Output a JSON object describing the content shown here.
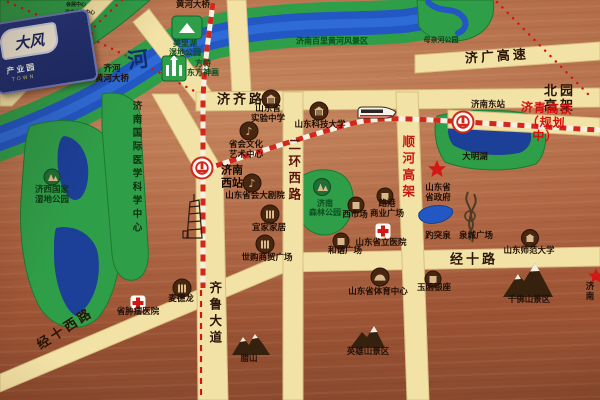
{
  "sign": {
    "main": "大风",
    "sub": "产业园",
    "tag": "TOWN"
  },
  "colors": {
    "copper_bg": "#aa5f3e",
    "road": "#f2e2a6",
    "road_edge": "#d9bf82",
    "park_green": "#2f9e49",
    "park_edge": "#1b7a33",
    "water_blue": "#2257c4",
    "lake_dark": "#1c3f98",
    "rail_red": "#d3261c",
    "rail_white": "#f5f1e2",
    "hsr_text_red": "#d40f0f",
    "label_dark": "#211007",
    "badge_brown": "#48260f",
    "badge_tan": "#d9b98c",
    "mountain_brown": "#36200e",
    "star_red": "#d21717",
    "cross_red": "#d21717"
  },
  "icons": [
    "railway-station-icon",
    "red-cross-icon",
    "red-star-icon",
    "mountain-icon",
    "building-badge-icon",
    "music-badge-icon",
    "trees-badge-icon",
    "stadium-badge-icon",
    "castle-park-icon",
    "wetland-hill-icon",
    "spring-sculpture-icon",
    "hst-train-icon",
    "tower-sketch-icon",
    "wetland-badge-icon"
  ],
  "map": {
    "labels": [
      {
        "name": "label-huanghe-bridge-top",
        "t": "黄河大桥",
        "x": 193,
        "y": 6,
        "cls": "poi"
      },
      {
        "name": "label-qihe-huanghe-bridge",
        "t": "齐河\n黄河大桥",
        "x": 112,
        "y": 75,
        "cls": "poi"
      },
      {
        "name": "label-jiqi-road",
        "t": "济齐路",
        "x": 241,
        "y": 101,
        "cls": "road"
      },
      {
        "name": "label-beiyuan-elevated",
        "t": "北园高架",
        "x": 560,
        "y": 100,
        "cls": "road"
      },
      {
        "name": "label-jiguang-expressway",
        "t": "济广高速",
        "x": 497,
        "y": 58,
        "cls": "road",
        "rot": -4
      },
      {
        "name": "label-jiqing-hsr",
        "t": "济青高铁（规划中）",
        "x": 546,
        "y": 123,
        "cls": "hsr",
        "rot": 3
      },
      {
        "name": "label-jinan-east-station",
        "t": "济南东站",
        "x": 488,
        "y": 106,
        "cls": "poi"
      },
      {
        "name": "label-shunhe-elevated",
        "t": "顺河高架",
        "x": 407,
        "y": 168,
        "cls": "roadv red-road"
      },
      {
        "name": "label-erhuan-west-road",
        "t": "二环西路",
        "x": 293,
        "y": 171,
        "cls": "roadv dark-red-road"
      },
      {
        "name": "label-qilu-avenue",
        "t": "齐鲁大道",
        "x": 214,
        "y": 314,
        "cls": "roadv"
      },
      {
        "name": "label-jingshi-road",
        "t": "经十路",
        "x": 474,
        "y": 261,
        "cls": "road"
      },
      {
        "name": "label-jingshi-west-road",
        "t": "经十西路",
        "x": 66,
        "y": 330,
        "cls": "road",
        "rot": -33
      },
      {
        "name": "label-yellow-river-char",
        "t": "河",
        "x": 138,
        "y": 60,
        "cls": "riverchar",
        "rot": -8
      },
      {
        "name": "label-baili-scenic",
        "t": "济南百里黄河风景区",
        "x": 332,
        "y": 41,
        "cls": "park-sm"
      },
      {
        "name": "label-mother-river-park",
        "t": "母亲河公园",
        "x": 441,
        "y": 40,
        "cls": "park-xs"
      },
      {
        "name": "label-meilihu-park",
        "t": "美里湖\n湿地公园",
        "x": 185,
        "y": 48,
        "cls": "park-sm"
      },
      {
        "name": "label-fangte-park",
        "t": "方特\n东方神画",
        "x": 203,
        "y": 68,
        "cls": "park-sm"
      },
      {
        "name": "label-jixi-wetland",
        "t": "济西国家\n湿地公园",
        "x": 52,
        "y": 196,
        "cls": "park-dark"
      },
      {
        "name": "label-medical-center",
        "t": "济南国际医学科学中心",
        "x": 135,
        "y": 168,
        "cls": "parkv"
      },
      {
        "name": "label-forest-park",
        "t": "济南\n森林公园",
        "x": 325,
        "y": 208,
        "cls": "park-sm"
      },
      {
        "name": "label-daming-lake",
        "t": "大明湖",
        "x": 475,
        "y": 158,
        "cls": "poi"
      },
      {
        "name": "label-experimental-school",
        "t": "山东省\n实验中学",
        "x": 268,
        "y": 115,
        "cls": "poi"
      },
      {
        "name": "label-sdust",
        "t": "山东科技大学",
        "x": 320,
        "y": 126,
        "cls": "poi"
      },
      {
        "name": "label-culture-art-center",
        "t": "省会文化\n艺术中心",
        "x": 246,
        "y": 151,
        "cls": "poi"
      },
      {
        "name": "label-grand-theatre",
        "t": "山东省会大剧院",
        "x": 255,
        "y": 197,
        "cls": "poi"
      },
      {
        "name": "label-jinan-west-station",
        "t": "济南\n西站",
        "x": 232,
        "y": 177,
        "cls": "station"
      },
      {
        "name": "label-ikea",
        "t": "宜家家居",
        "x": 269,
        "y": 229,
        "cls": "poi"
      },
      {
        "name": "label-shigou-plaza",
        "t": "世购商贸广场",
        "x": 267,
        "y": 259,
        "cls": "poi"
      },
      {
        "name": "label-west-market",
        "t": "西市场",
        "x": 355,
        "y": 216,
        "cls": "poi"
      },
      {
        "name": "label-lugang-plaza",
        "t": "路港\n商业广场",
        "x": 387,
        "y": 210,
        "cls": "poi"
      },
      {
        "name": "label-hexie-plaza",
        "t": "和谐广场",
        "x": 345,
        "y": 252,
        "cls": "poi"
      },
      {
        "name": "label-provincial-hospital",
        "t": "山东省立医院",
        "x": 381,
        "y": 244,
        "cls": "poi"
      },
      {
        "name": "label-baotu-spring",
        "t": "趵突泉",
        "x": 438,
        "y": 237,
        "cls": "poi"
      },
      {
        "name": "label-quancheng-square",
        "t": "泉城广场",
        "x": 476,
        "y": 237,
        "cls": "poi"
      },
      {
        "name": "label-prov-government",
        "t": "山东省\n省政府",
        "x": 438,
        "y": 194,
        "cls": "poi"
      },
      {
        "name": "label-shandong-normal-univ",
        "t": "山东师范大学",
        "x": 529,
        "y": 252,
        "cls": "poi"
      },
      {
        "name": "label-yuhan-yinzuo",
        "t": "玉函银座",
        "x": 434,
        "y": 289,
        "cls": "poi"
      },
      {
        "name": "label-sports-center",
        "t": "山东省体育中心",
        "x": 378,
        "y": 293,
        "cls": "poi"
      },
      {
        "name": "label-metro-store",
        "t": "麦德龙",
        "x": 181,
        "y": 300,
        "cls": "poi"
      },
      {
        "name": "label-tumor-hospital",
        "t": "省肿瘤医院",
        "x": 138,
        "y": 313,
        "cls": "poi"
      },
      {
        "name": "label-lashan",
        "t": "腊山",
        "x": 249,
        "y": 360,
        "cls": "poi"
      },
      {
        "name": "label-yingxiongshan",
        "t": "英雄山景区",
        "x": 368,
        "y": 353,
        "cls": "poi"
      },
      {
        "name": "label-qianfoshan",
        "t": "千佛山景区",
        "x": 529,
        "y": 301,
        "cls": "poi"
      },
      {
        "name": "label-jinan-right-edge",
        "t": "济南",
        "x": 590,
        "y": 293,
        "cls": "poi"
      },
      {
        "name": "label-expo-center",
        "t": "会展中心",
        "x": 76,
        "y": 6,
        "cls": "tiny"
      },
      {
        "name": "label-hotspring-center",
        "t": "温泉体验中心",
        "x": 80,
        "y": 14,
        "cls": "tiny"
      },
      {
        "name": "label-hotspring-hotel",
        "t": "温泉酒店",
        "x": 78,
        "y": 23,
        "cls": "tiny"
      }
    ]
  }
}
